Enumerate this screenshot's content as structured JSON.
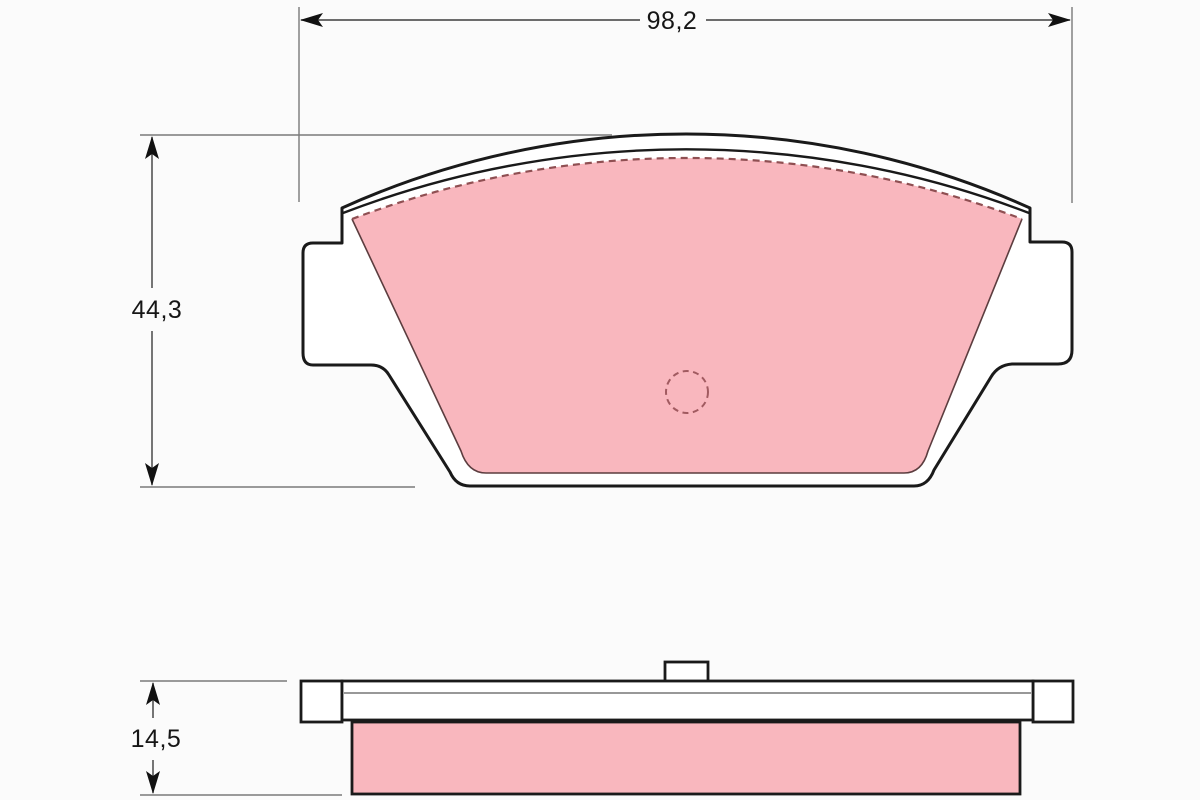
{
  "dimensions": {
    "width": "98,2",
    "height": "44,3",
    "thickness": "14,5"
  },
  "colors": {
    "friction_pink": "#f9b7be",
    "outline_black": "#1a1a1a",
    "hidden_edge_red": "#8f4f52",
    "hidden_circle_red": "#a15a60",
    "dimension_line_gray": "#3c3c3c",
    "extension_line_gray": "#7a7a7a",
    "plate_white": "#ffffff",
    "background": "#fbfbfb"
  }
}
